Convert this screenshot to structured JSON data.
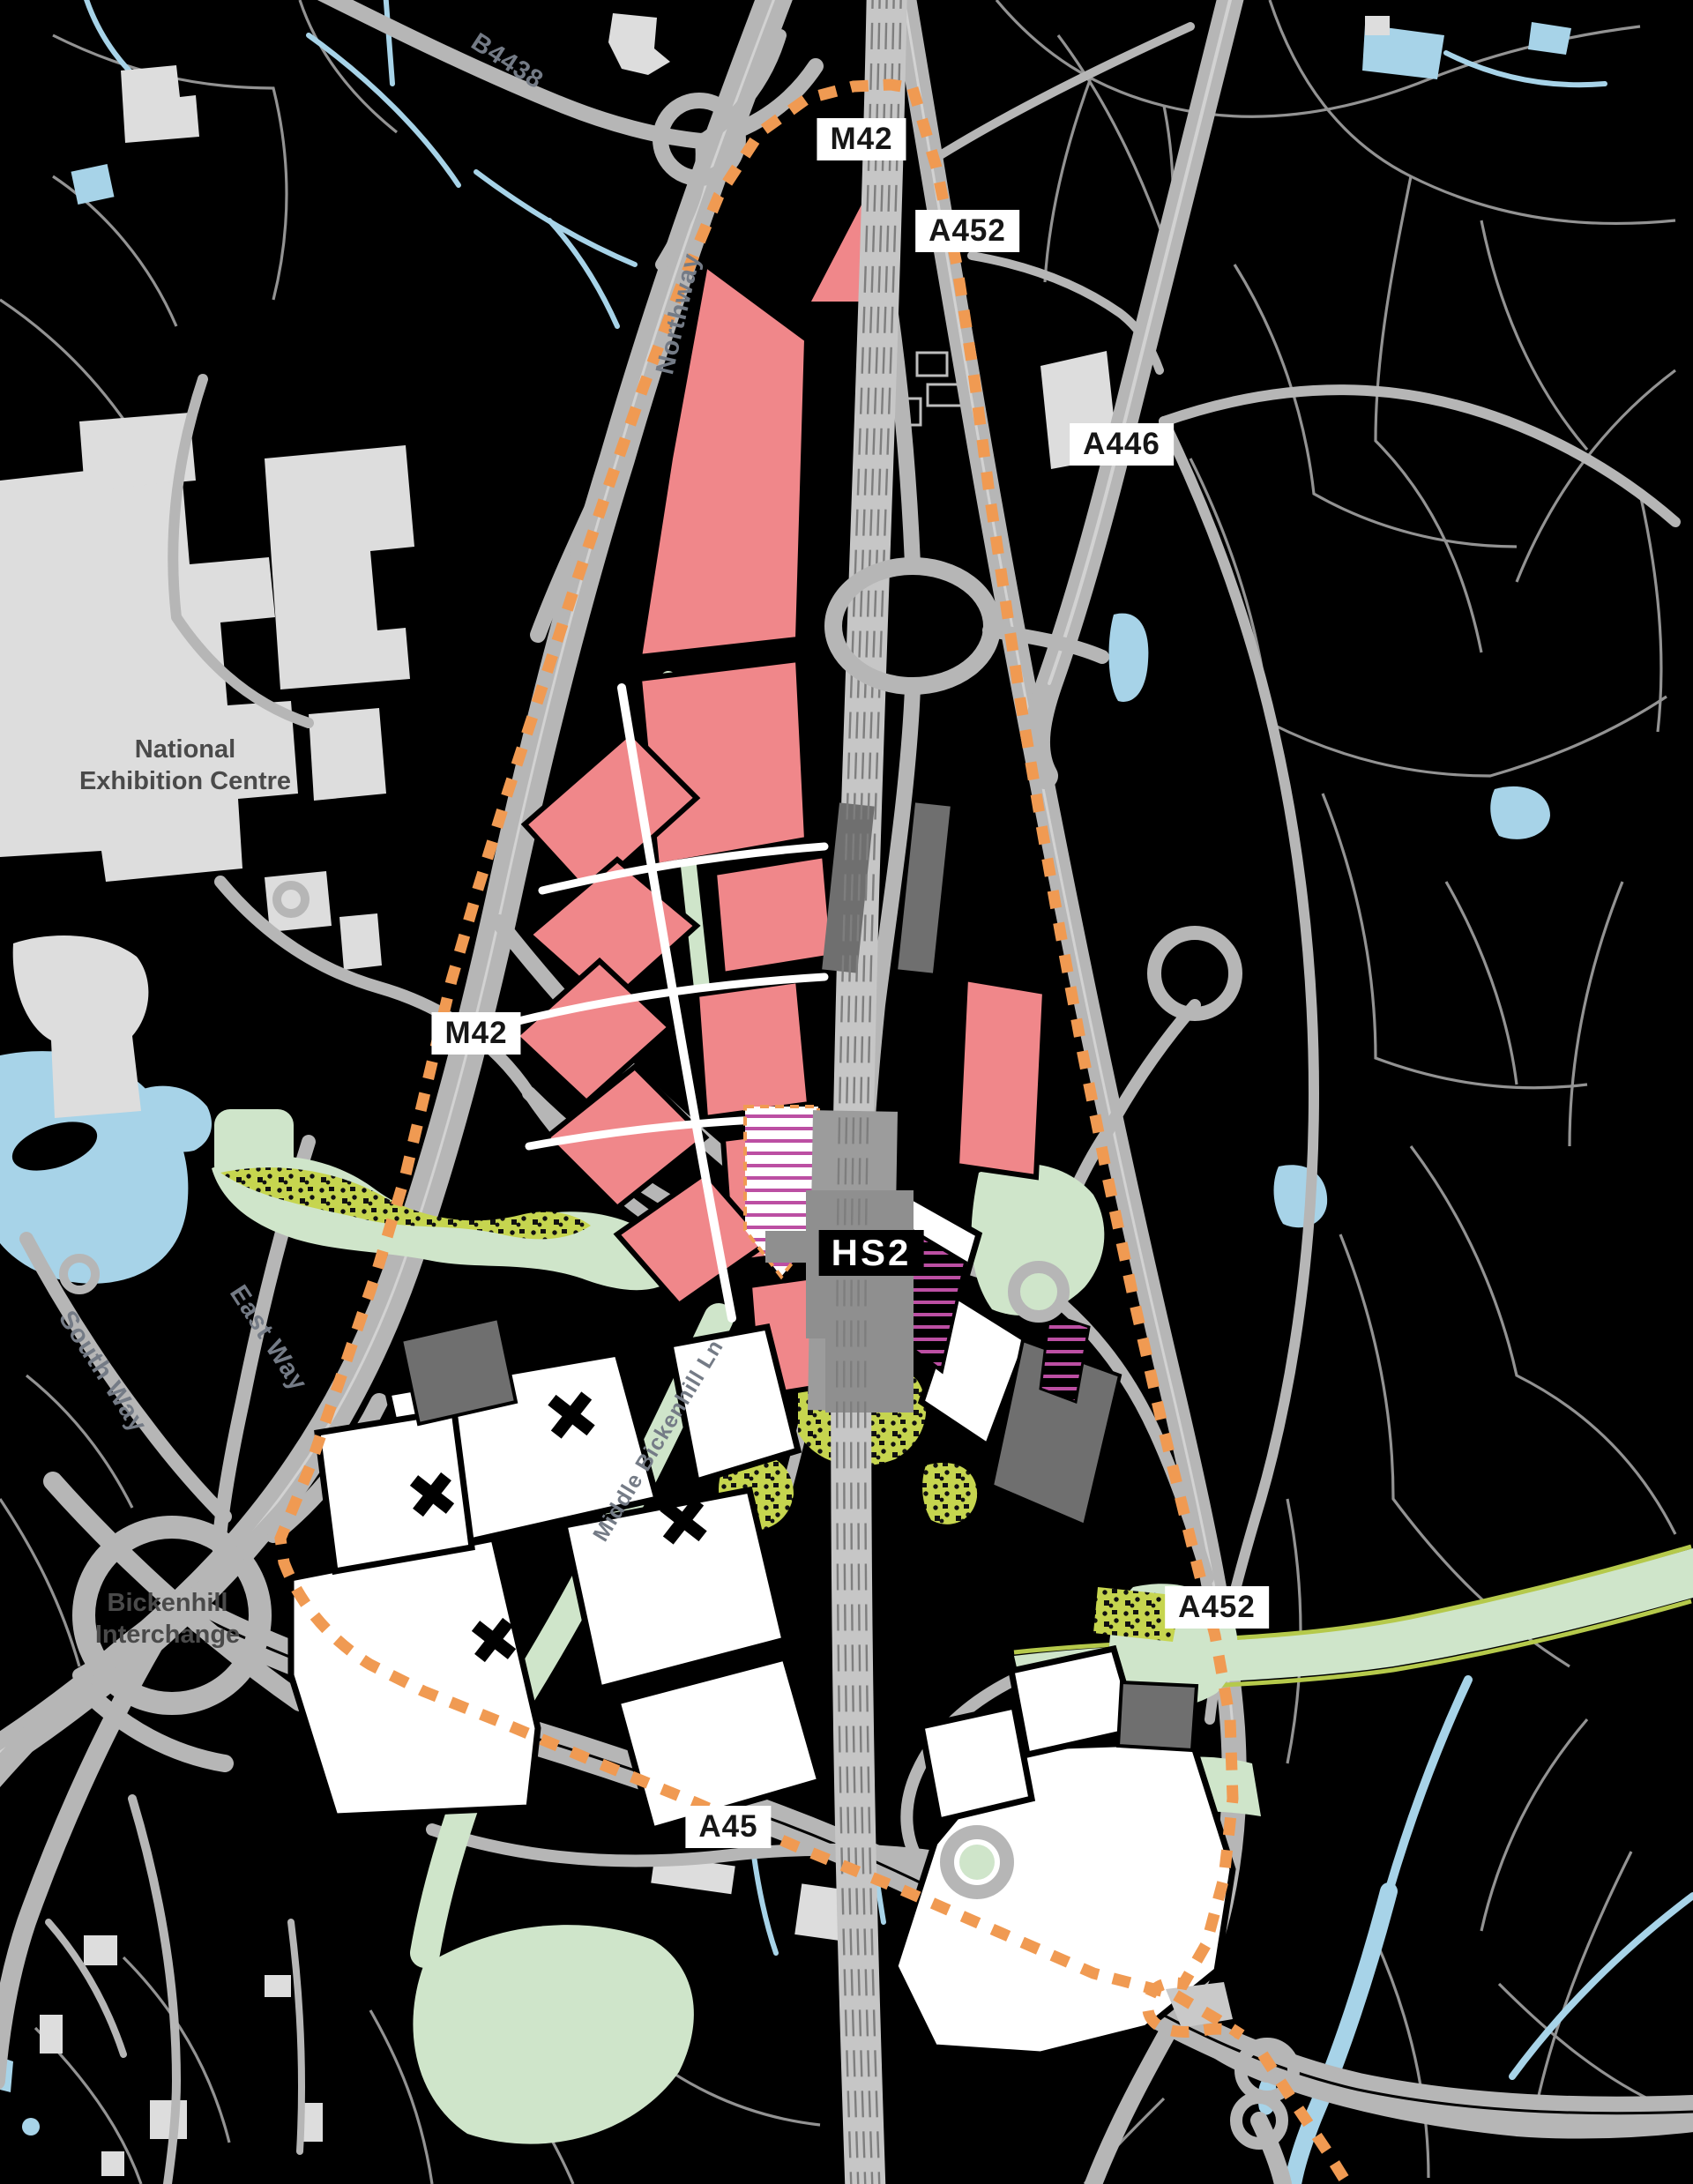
{
  "labels": {
    "badges": {
      "m42_top": "M42",
      "a452_north": "A452",
      "a446": "A446",
      "m42_west": "M42",
      "a452_east": "A452",
      "a45": "A45"
    },
    "places": {
      "nec1": "National",
      "nec2": "Exhibition Centre",
      "bick1": "Bickenhill",
      "bick2": "Interchange"
    },
    "roads": {
      "northway": "Northway",
      "b4438": "B4438",
      "south_way": "South Way",
      "east_way": "East Way",
      "middle_bickenhill": "Middle Bickenhill Ln"
    },
    "station": {
      "hs2": "HS2"
    }
  },
  "colors": {
    "bg": "#000000",
    "field": "#9B9B9B",
    "road": "#B6B6B6",
    "road_light": "#D2D2D2",
    "water": "#A7D3E8",
    "building": "#DDDDDD",
    "pink": "#F0878A",
    "white_parcel": "#FFFFFF",
    "dark_parcel": "#6F6F6F",
    "rail_band": "#C6C6C6",
    "rail_line": "#7E7E7E",
    "station_gray": "#8F8F8F",
    "green": "#CFE5CA",
    "olive": "#C6D54F",
    "olive_edge": "#B5C94B",
    "boundary_orange": "#F09A52",
    "magenta": "#BC4FA3",
    "label_dark": "#4A4A4A",
    "label_road": "#747B86",
    "badge_bg": "#FFFFFF",
    "badge_text": "#161616"
  }
}
